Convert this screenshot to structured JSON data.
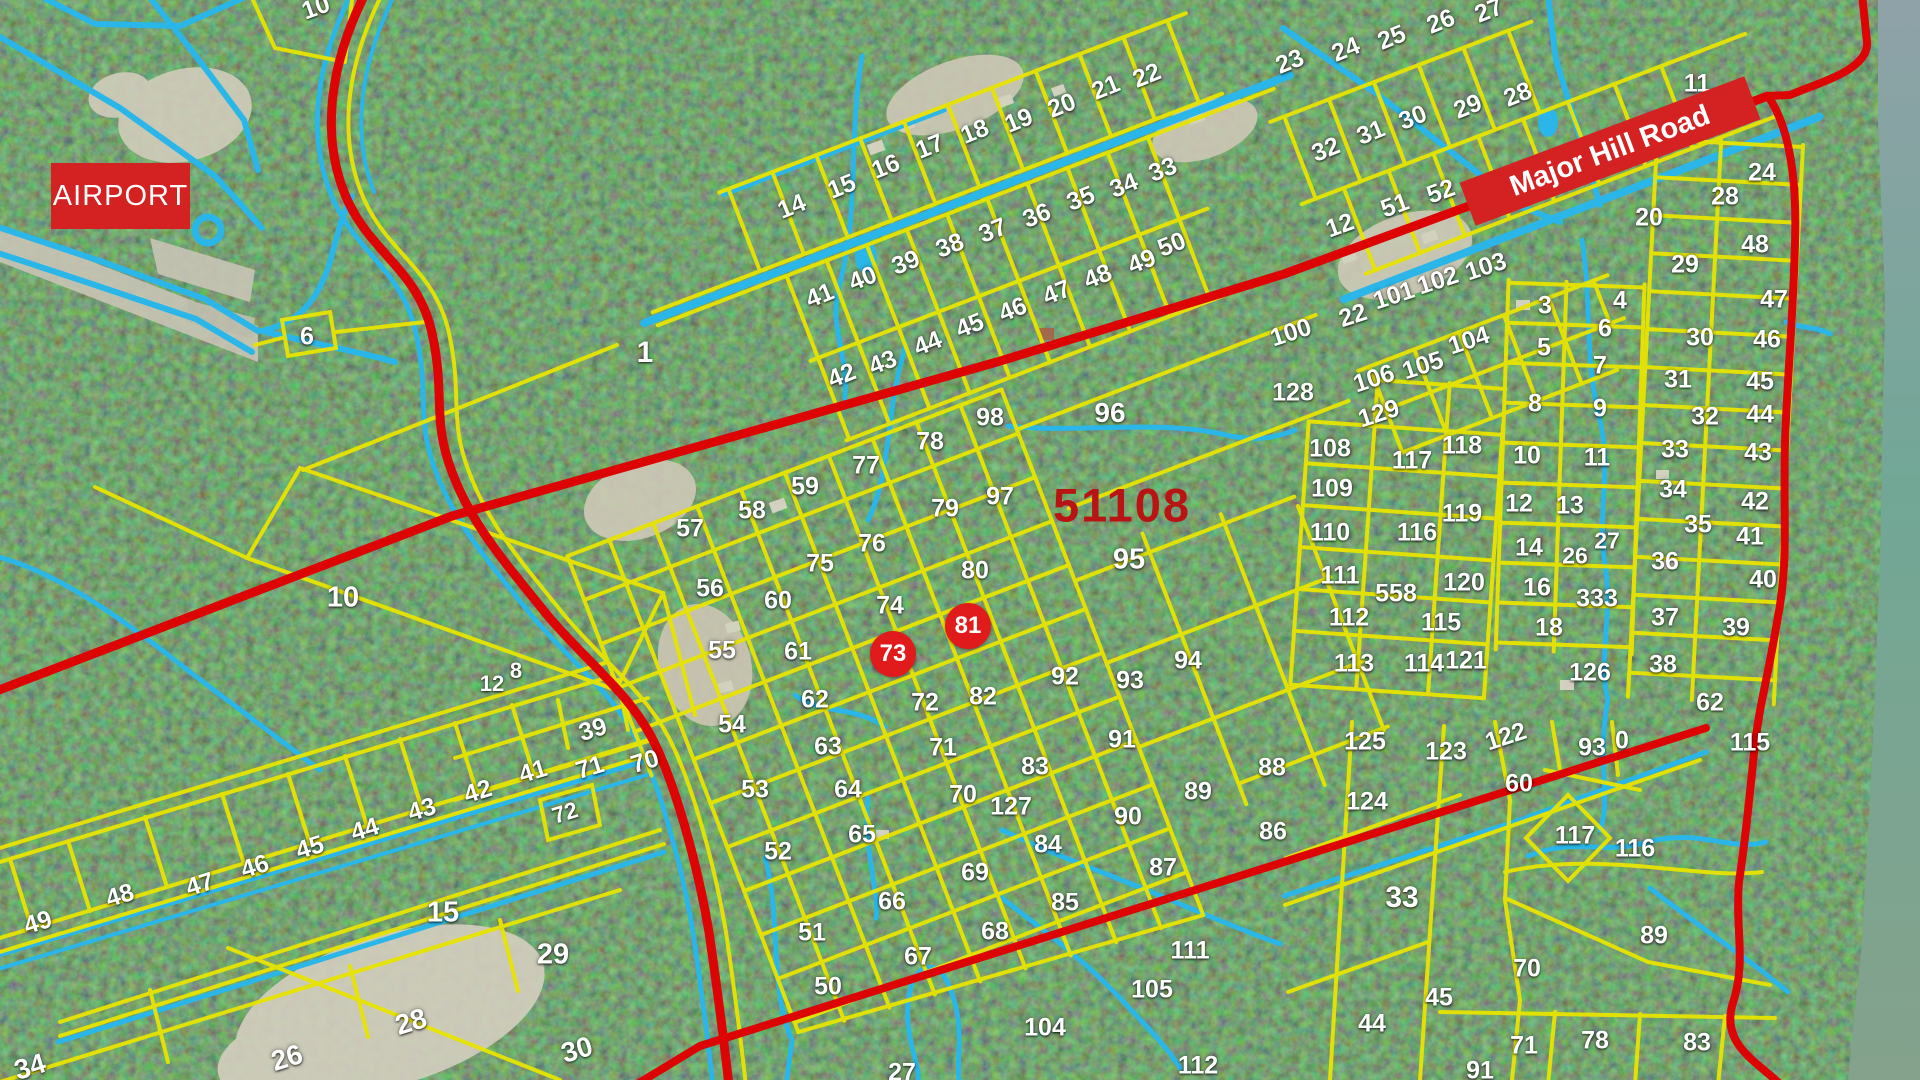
{
  "map": {
    "airport_label": "AIRPORT",
    "road_label": "Major Hill Road",
    "region_code": "51108",
    "colors": {
      "parcel_line": "#e8e400",
      "waterway": "#2ab6e8",
      "road": "#dc0404",
      "water_body": "#7aa796",
      "label_text": "#ffffff",
      "region_code": "#b81414",
      "banner": "#d42121",
      "marker": "#e11b1b"
    },
    "markers": [
      {
        "t": "73",
        "x": 893,
        "y": 654
      },
      {
        "t": "81",
        "x": 968,
        "y": 626
      }
    ],
    "labels": [
      {
        "t": "10",
        "x": 316,
        "y": 8,
        "r": -20
      },
      {
        "t": "6",
        "x": 307,
        "y": 337
      },
      {
        "t": "1",
        "x": 645,
        "y": 353,
        "s": 30
      },
      {
        "t": "10",
        "x": 343,
        "y": 598,
        "s": 29
      },
      {
        "t": "12",
        "x": 492,
        "y": 684,
        "s": 22
      },
      {
        "t": "8",
        "x": 516,
        "y": 671,
        "s": 22
      },
      {
        "t": "14",
        "x": 792,
        "y": 207,
        "r": -22
      },
      {
        "t": "15",
        "x": 842,
        "y": 187,
        "r": -22
      },
      {
        "t": "16",
        "x": 886,
        "y": 167,
        "r": -22
      },
      {
        "t": "17",
        "x": 930,
        "y": 147,
        "r": -22
      },
      {
        "t": "18",
        "x": 975,
        "y": 132,
        "r": -22
      },
      {
        "t": "19",
        "x": 1019,
        "y": 121,
        "r": -22
      },
      {
        "t": "20",
        "x": 1062,
        "y": 106,
        "r": -22
      },
      {
        "t": "21",
        "x": 1106,
        "y": 88,
        "r": -22
      },
      {
        "t": "22",
        "x": 1147,
        "y": 76,
        "r": -22
      },
      {
        "t": "23",
        "x": 1290,
        "y": 62,
        "r": -22
      },
      {
        "t": "24",
        "x": 1346,
        "y": 50,
        "r": -22
      },
      {
        "t": "25",
        "x": 1392,
        "y": 38,
        "r": -22
      },
      {
        "t": "26",
        "x": 1441,
        "y": 22,
        "r": -22
      },
      {
        "t": "27",
        "x": 1489,
        "y": 11,
        "r": -22
      },
      {
        "t": "33",
        "x": 1163,
        "y": 170,
        "r": -22
      },
      {
        "t": "34",
        "x": 1124,
        "y": 186,
        "r": -22
      },
      {
        "t": "35",
        "x": 1081,
        "y": 199,
        "r": -22
      },
      {
        "t": "36",
        "x": 1037,
        "y": 216,
        "r": -22
      },
      {
        "t": "37",
        "x": 993,
        "y": 231,
        "r": -22
      },
      {
        "t": "38",
        "x": 950,
        "y": 246,
        "r": -22
      },
      {
        "t": "39",
        "x": 906,
        "y": 263,
        "r": -22
      },
      {
        "t": "40",
        "x": 863,
        "y": 279,
        "r": -22
      },
      {
        "t": "41",
        "x": 820,
        "y": 296,
        "r": -22
      },
      {
        "t": "28",
        "x": 1518,
        "y": 95,
        "r": -22
      },
      {
        "t": "29",
        "x": 1468,
        "y": 107,
        "r": -22
      },
      {
        "t": "30",
        "x": 1413,
        "y": 118,
        "r": -22
      },
      {
        "t": "31",
        "x": 1371,
        "y": 133,
        "r": -22
      },
      {
        "t": "32",
        "x": 1326,
        "y": 150,
        "r": -22
      },
      {
        "t": "42",
        "x": 842,
        "y": 376,
        "r": -22
      },
      {
        "t": "43",
        "x": 883,
        "y": 363,
        "r": -22
      },
      {
        "t": "44",
        "x": 928,
        "y": 344,
        "r": -22
      },
      {
        "t": "45",
        "x": 970,
        "y": 326,
        "r": -22
      },
      {
        "t": "46",
        "x": 1013,
        "y": 310,
        "r": -22
      },
      {
        "t": "47",
        "x": 1057,
        "y": 293,
        "r": -22
      },
      {
        "t": "48",
        "x": 1098,
        "y": 277,
        "r": -22
      },
      {
        "t": "49",
        "x": 1142,
        "y": 262,
        "r": -22
      },
      {
        "t": "50",
        "x": 1172,
        "y": 245,
        "r": -22
      },
      {
        "t": "51",
        "x": 1395,
        "y": 206,
        "r": -20
      },
      {
        "t": "52",
        "x": 1441,
        "y": 192,
        "r": -20
      },
      {
        "t": "12",
        "x": 1340,
        "y": 226,
        "r": -20
      },
      {
        "t": "20",
        "x": 1649,
        "y": 218
      },
      {
        "t": "11",
        "x": 1697,
        "y": 84
      },
      {
        "t": "100",
        "x": 1291,
        "y": 333,
        "r": -18
      },
      {
        "t": "22",
        "x": 1353,
        "y": 316,
        "r": -18
      },
      {
        "t": "101",
        "x": 1394,
        "y": 296,
        "r": -18
      },
      {
        "t": "102",
        "x": 1438,
        "y": 281,
        "r": -18
      },
      {
        "t": "103",
        "x": 1486,
        "y": 267,
        "r": -18
      },
      {
        "t": "104",
        "x": 1469,
        "y": 341,
        "r": -18
      },
      {
        "t": "105",
        "x": 1423,
        "y": 366,
        "r": -18
      },
      {
        "t": "106",
        "x": 1374,
        "y": 379,
        "r": -18
      },
      {
        "t": "129",
        "x": 1379,
        "y": 414,
        "r": -18
      },
      {
        "t": "128",
        "x": 1293,
        "y": 393
      },
      {
        "t": "96",
        "x": 1110,
        "y": 413,
        "s": 28
      },
      {
        "t": "95",
        "x": 1129,
        "y": 560,
        "s": 29
      },
      {
        "t": "98",
        "x": 990,
        "y": 418
      },
      {
        "t": "78",
        "x": 930,
        "y": 442
      },
      {
        "t": "77",
        "x": 866,
        "y": 466
      },
      {
        "t": "97",
        "x": 1000,
        "y": 497
      },
      {
        "t": "79",
        "x": 945,
        "y": 509
      },
      {
        "t": "76",
        "x": 872,
        "y": 544
      },
      {
        "t": "75",
        "x": 820,
        "y": 564
      },
      {
        "t": "59",
        "x": 805,
        "y": 487
      },
      {
        "t": "58",
        "x": 752,
        "y": 511
      },
      {
        "t": "57",
        "x": 690,
        "y": 529
      },
      {
        "t": "56",
        "x": 710,
        "y": 589
      },
      {
        "t": "60",
        "x": 778,
        "y": 601
      },
      {
        "t": "80",
        "x": 975,
        "y": 571
      },
      {
        "t": "74",
        "x": 890,
        "y": 606
      },
      {
        "t": "55",
        "x": 722,
        "y": 651
      },
      {
        "t": "61",
        "x": 798,
        "y": 652
      },
      {
        "t": "92",
        "x": 1065,
        "y": 677
      },
      {
        "t": "93",
        "x": 1130,
        "y": 681
      },
      {
        "t": "94",
        "x": 1188,
        "y": 661
      },
      {
        "t": "82",
        "x": 983,
        "y": 697
      },
      {
        "t": "62",
        "x": 815,
        "y": 700
      },
      {
        "t": "72",
        "x": 925,
        "y": 703
      },
      {
        "t": "54",
        "x": 732,
        "y": 725
      },
      {
        "t": "63",
        "x": 828,
        "y": 747
      },
      {
        "t": "71",
        "x": 943,
        "y": 748
      },
      {
        "t": "53",
        "x": 755,
        "y": 790
      },
      {
        "t": "64",
        "x": 848,
        "y": 790
      },
      {
        "t": "70",
        "x": 963,
        "y": 795
      },
      {
        "t": "65",
        "x": 862,
        "y": 835
      },
      {
        "t": "52",
        "x": 778,
        "y": 852
      },
      {
        "t": "66",
        "x": 892,
        "y": 902
      },
      {
        "t": "51",
        "x": 812,
        "y": 933
      },
      {
        "t": "69",
        "x": 975,
        "y": 873
      },
      {
        "t": "68",
        "x": 995,
        "y": 932
      },
      {
        "t": "67",
        "x": 918,
        "y": 957
      },
      {
        "t": "50",
        "x": 828,
        "y": 987
      },
      {
        "t": "83",
        "x": 1035,
        "y": 767
      },
      {
        "t": "91",
        "x": 1122,
        "y": 740
      },
      {
        "t": "127",
        "x": 1011,
        "y": 807
      },
      {
        "t": "90",
        "x": 1128,
        "y": 817
      },
      {
        "t": "84",
        "x": 1048,
        "y": 845
      },
      {
        "t": "85",
        "x": 1065,
        "y": 903
      },
      {
        "t": "87",
        "x": 1163,
        "y": 868
      },
      {
        "t": "86",
        "x": 1273,
        "y": 832
      },
      {
        "t": "88",
        "x": 1272,
        "y": 768
      },
      {
        "t": "89",
        "x": 1198,
        "y": 792
      },
      {
        "t": "27",
        "x": 902,
        "y": 1073
      },
      {
        "t": "104",
        "x": 1045,
        "y": 1028
      },
      {
        "t": "105",
        "x": 1152,
        "y": 990
      },
      {
        "t": "111",
        "x": 1190,
        "y": 951
      },
      {
        "t": "112",
        "x": 1198,
        "y": 1066
      },
      {
        "t": "39",
        "x": 593,
        "y": 730,
        "r": -17
      },
      {
        "t": "71",
        "x": 590,
        "y": 768,
        "r": -17
      },
      {
        "t": "70",
        "x": 645,
        "y": 762,
        "r": -17
      },
      {
        "t": "41",
        "x": 533,
        "y": 772,
        "r": -17
      },
      {
        "t": "42",
        "x": 478,
        "y": 792,
        "r": -17
      },
      {
        "t": "43",
        "x": 422,
        "y": 810,
        "r": -17
      },
      {
        "t": "44",
        "x": 365,
        "y": 830,
        "r": -17
      },
      {
        "t": "45",
        "x": 310,
        "y": 848,
        "r": -17
      },
      {
        "t": "46",
        "x": 255,
        "y": 867,
        "r": -17
      },
      {
        "t": "47",
        "x": 200,
        "y": 885,
        "r": -17
      },
      {
        "t": "48",
        "x": 120,
        "y": 896,
        "r": -17
      },
      {
        "t": "49",
        "x": 38,
        "y": 923,
        "r": -17
      },
      {
        "t": "72",
        "x": 565,
        "y": 813,
        "r": -17,
        "s": 23
      },
      {
        "t": "15",
        "x": 443,
        "y": 913,
        "s": 29
      },
      {
        "t": "29",
        "x": 553,
        "y": 955,
        "s": 29
      },
      {
        "t": "28",
        "x": 411,
        "y": 1022,
        "r": -17,
        "s": 28
      },
      {
        "t": "26",
        "x": 287,
        "y": 1058,
        "r": -17,
        "s": 28
      },
      {
        "t": "30",
        "x": 577,
        "y": 1050,
        "r": -17,
        "s": 28
      },
      {
        "t": "34",
        "x": 30,
        "y": 1067,
        "r": -17,
        "s": 28
      },
      {
        "t": "108",
        "x": 1330,
        "y": 449
      },
      {
        "t": "109",
        "x": 1332,
        "y": 489
      },
      {
        "t": "110",
        "x": 1330,
        "y": 533
      },
      {
        "t": "111",
        "x": 1340,
        "y": 576
      },
      {
        "t": "112",
        "x": 1349,
        "y": 618
      },
      {
        "t": "113",
        "x": 1354,
        "y": 664
      },
      {
        "t": "117",
        "x": 1412,
        "y": 461
      },
      {
        "t": "118",
        "x": 1462,
        "y": 446
      },
      {
        "t": "116",
        "x": 1417,
        "y": 533
      },
      {
        "t": "119",
        "x": 1462,
        "y": 514
      },
      {
        "t": "558",
        "x": 1396,
        "y": 594
      },
      {
        "t": "120",
        "x": 1464,
        "y": 583
      },
      {
        "t": "115",
        "x": 1441,
        "y": 623
      },
      {
        "t": "114",
        "x": 1424,
        "y": 664
      },
      {
        "t": "121",
        "x": 1466,
        "y": 661
      },
      {
        "t": "126",
        "x": 1590,
        "y": 673
      },
      {
        "t": "3",
        "x": 1545,
        "y": 306
      },
      {
        "t": "4",
        "x": 1620,
        "y": 301
      },
      {
        "t": "5",
        "x": 1544,
        "y": 348
      },
      {
        "t": "6",
        "x": 1605,
        "y": 329
      },
      {
        "t": "7",
        "x": 1600,
        "y": 366
      },
      {
        "t": "8",
        "x": 1535,
        "y": 404
      },
      {
        "t": "9",
        "x": 1600,
        "y": 409
      },
      {
        "t": "10",
        "x": 1527,
        "y": 456
      },
      {
        "t": "11",
        "x": 1597,
        "y": 458
      },
      {
        "t": "12",
        "x": 1519,
        "y": 504
      },
      {
        "t": "13",
        "x": 1570,
        "y": 506
      },
      {
        "t": "14",
        "x": 1529,
        "y": 548
      },
      {
        "t": "26",
        "x": 1575,
        "y": 556,
        "s": 23
      },
      {
        "t": "27",
        "x": 1607,
        "y": 541,
        "s": 23
      },
      {
        "t": "16",
        "x": 1537,
        "y": 588
      },
      {
        "t": "333",
        "x": 1597,
        "y": 599
      },
      {
        "t": "18",
        "x": 1549,
        "y": 628
      },
      {
        "t": "24",
        "x": 1762,
        "y": 173
      },
      {
        "t": "28",
        "x": 1725,
        "y": 197
      },
      {
        "t": "29",
        "x": 1685,
        "y": 265
      },
      {
        "t": "30",
        "x": 1700,
        "y": 338
      },
      {
        "t": "31",
        "x": 1678,
        "y": 380
      },
      {
        "t": "32",
        "x": 1705,
        "y": 417
      },
      {
        "t": "33",
        "x": 1675,
        "y": 450
      },
      {
        "t": "34",
        "x": 1673,
        "y": 490
      },
      {
        "t": "35",
        "x": 1698,
        "y": 525
      },
      {
        "t": "36",
        "x": 1665,
        "y": 562
      },
      {
        "t": "37",
        "x": 1665,
        "y": 618
      },
      {
        "t": "38",
        "x": 1663,
        "y": 665
      },
      {
        "t": "62",
        "x": 1710,
        "y": 703
      },
      {
        "t": "48",
        "x": 1755,
        "y": 245
      },
      {
        "t": "47",
        "x": 1774,
        "y": 300
      },
      {
        "t": "46",
        "x": 1767,
        "y": 340
      },
      {
        "t": "45",
        "x": 1760,
        "y": 382
      },
      {
        "t": "44",
        "x": 1760,
        "y": 415
      },
      {
        "t": "43",
        "x": 1758,
        "y": 453
      },
      {
        "t": "42",
        "x": 1755,
        "y": 502
      },
      {
        "t": "41",
        "x": 1750,
        "y": 537
      },
      {
        "t": "40",
        "x": 1763,
        "y": 580
      },
      {
        "t": "39",
        "x": 1736,
        "y": 628
      },
      {
        "t": "125",
        "x": 1365,
        "y": 742
      },
      {
        "t": "123",
        "x": 1446,
        "y": 752
      },
      {
        "t": "122",
        "x": 1506,
        "y": 737,
        "r": -18
      },
      {
        "t": "93",
        "x": 1592,
        "y": 748
      },
      {
        "t": "0",
        "x": 1622,
        "y": 741
      },
      {
        "t": "115",
        "x": 1750,
        "y": 743
      },
      {
        "t": "124",
        "x": 1367,
        "y": 802
      },
      {
        "t": "60",
        "x": 1519,
        "y": 784
      },
      {
        "t": "117",
        "x": 1575,
        "y": 836
      },
      {
        "t": "116",
        "x": 1635,
        "y": 849
      },
      {
        "t": "33",
        "x": 1402,
        "y": 898,
        "s": 30
      },
      {
        "t": "89",
        "x": 1654,
        "y": 936
      },
      {
        "t": "70",
        "x": 1527,
        "y": 969
      },
      {
        "t": "45",
        "x": 1439,
        "y": 998
      },
      {
        "t": "44",
        "x": 1372,
        "y": 1024
      },
      {
        "t": "71",
        "x": 1524,
        "y": 1046
      },
      {
        "t": "78",
        "x": 1595,
        "y": 1041
      },
      {
        "t": "83",
        "x": 1697,
        "y": 1043
      },
      {
        "t": "91",
        "x": 1480,
        "y": 1071
      }
    ]
  }
}
